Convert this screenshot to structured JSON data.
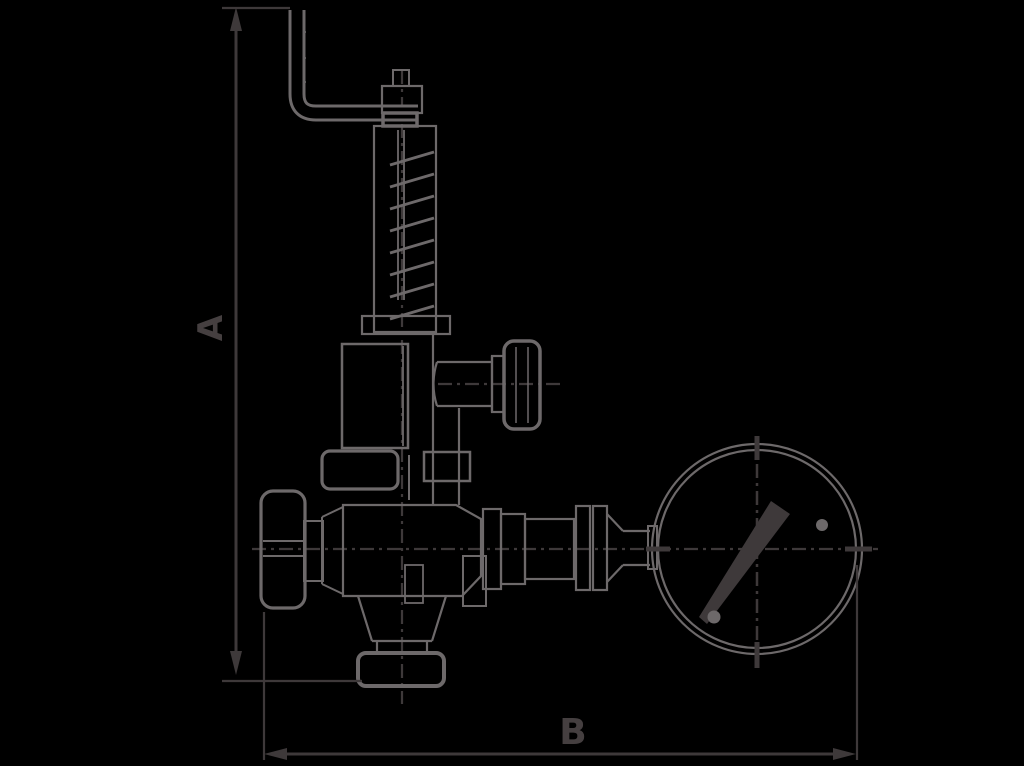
{
  "diagram": {
    "type": "technical-line-drawing",
    "subject": "angle pressure-reducing valve with top lever handle, spring housing, side gauge-port cap, handwheel and pressure gauge",
    "dimensions": {
      "vertical_label": "A",
      "horizontal_label": "B"
    },
    "colors": {
      "background": "#000000",
      "ink": "#3e393a",
      "edge": "#6d696a",
      "label": "#453f40"
    },
    "parts": [
      "lever-handle",
      "adjusting-screw-fitting",
      "spring-housing",
      "spring-coil",
      "bonnet",
      "side-gauge-port-cap",
      "inlet-flange",
      "valve-body",
      "handwheel",
      "bottom-outlet-flange",
      "outlet-union",
      "gauge-pipe",
      "pressure-gauge",
      "gauge-needle",
      "dimension-line-A",
      "dimension-line-B",
      "centerlines"
    ]
  }
}
